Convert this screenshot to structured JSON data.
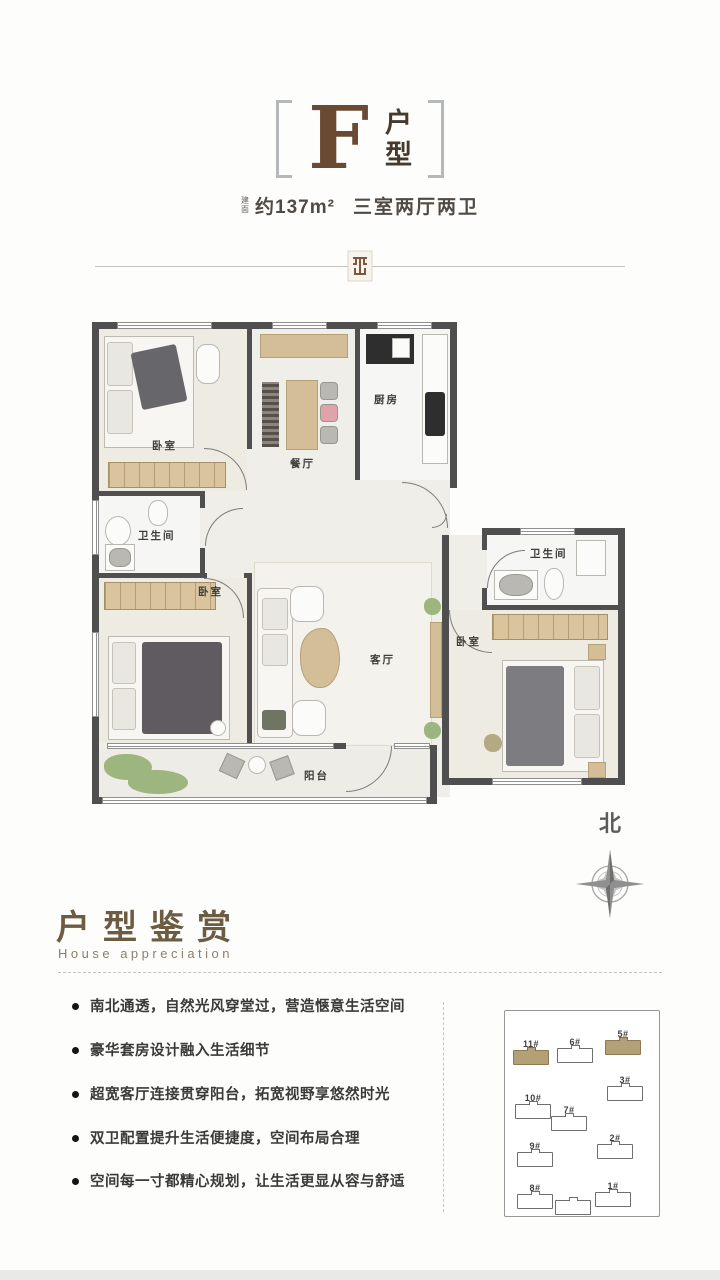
{
  "header": {
    "unit_letter": "F",
    "unit_char1": "户",
    "unit_char2": "型",
    "area_label_1": "建",
    "area_label_2": "面",
    "area": "约137m²",
    "rooms": "三室两厅两卫"
  },
  "floorplan": {
    "labels": {
      "bedroom1": "卧室",
      "dining": "餐厅",
      "kitchen": "厨房",
      "bath1": "卫生间",
      "bedroom2": "卧室",
      "living": "客厅",
      "balcony": "阳台",
      "bath2": "卫生间",
      "bedroom3": "卧室"
    },
    "compass": "北"
  },
  "appreciation": {
    "title": "户型鉴赏",
    "subtitle": "House appreciation"
  },
  "features": [
    "南北通透，自然光风穿堂过，营造惬意生活空间",
    "豪华套房设计融入生活细节",
    "超宽客厅连接贯穿阳台，拓宽视野享悠然时光",
    "双卫配置提升生活便捷度，空间布局合理",
    "空间每一寸都精心规划，让生活更显从容与舒适"
  ],
  "siteplan": {
    "buildings": [
      {
        "label": "11#",
        "highlight": true
      },
      {
        "label": "6#",
        "highlight": false
      },
      {
        "label": "5#",
        "highlight": true
      },
      {
        "label": "3#",
        "highlight": false
      },
      {
        "label": "10#",
        "highlight": false
      },
      {
        "label": "7#",
        "highlight": false
      },
      {
        "label": "2#",
        "highlight": false
      },
      {
        "label": "9#",
        "highlight": false
      },
      {
        "label": "8#",
        "highlight": false
      },
      {
        "label": "",
        "highlight": false
      },
      {
        "label": "1#",
        "highlight": false
      }
    ]
  },
  "colors": {
    "accent_brown": "#6b4a33",
    "wall": "#4f4f4f",
    "highlight_tan": "#b4a077"
  }
}
